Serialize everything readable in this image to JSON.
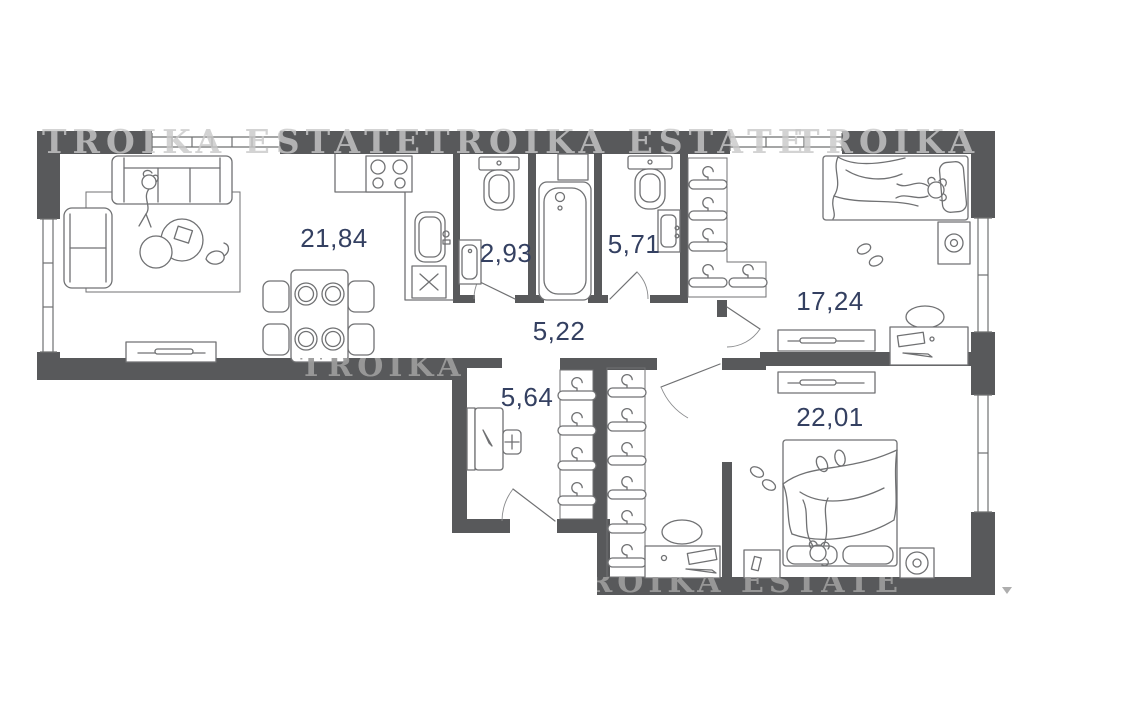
{
  "watermark": {
    "text": "TROIKA ESTATE",
    "color": "#c9c9c9"
  },
  "colors": {
    "wall": "#58595b",
    "furniture_line": "#707173",
    "label": "#344061",
    "background": "#ffffff"
  },
  "rooms": [
    {
      "name": "living-room-kitchen",
      "area": "21,84",
      "furniture": [
        "sofa",
        "person-on-sofa",
        "armchair",
        "rug",
        "coffee-tables",
        "cat",
        "tv-stand",
        "dining-table",
        "dining-chairs",
        "plates",
        "stove",
        "kitchen-counter",
        "kitchen-sink",
        "kitchen-cabinet"
      ]
    },
    {
      "name": "wc",
      "area": "2,93",
      "furniture": [
        "toilet",
        "wash-basin"
      ]
    },
    {
      "name": "bathroom",
      "area": "5,71",
      "furniture": [
        "toilet",
        "wall-sink",
        "bathtub"
      ]
    },
    {
      "name": "hallway",
      "area": "5,22",
      "furniture": []
    },
    {
      "name": "bedroom-1",
      "area": "17,24",
      "furniture": [
        "single-bed",
        "sleeping-person",
        "pillow",
        "nightstand-lamp",
        "slippers",
        "desk",
        "chair",
        "dresser",
        "wardrobe-hangers"
      ]
    },
    {
      "name": "entry-wardrobe",
      "area": "5,64",
      "furniture": [
        "console-mirror",
        "stool",
        "hanger-rack",
        "entrance-door"
      ]
    },
    {
      "name": "bedroom-2",
      "area": "22,01",
      "furniture": [
        "double-bed",
        "sleeping-person",
        "pillows",
        "nightstand",
        "lamp",
        "slippers",
        "desk",
        "chair",
        "dresser",
        "hanger-rack"
      ]
    }
  ],
  "icons": {
    "cursor_marker": "small-triangle"
  }
}
